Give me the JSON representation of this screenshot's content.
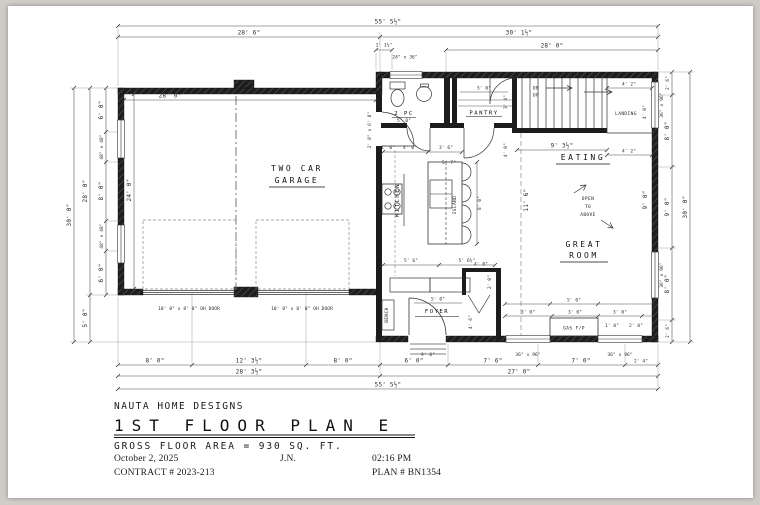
{
  "title_block": {
    "company": "NAUTA HOME DESIGNS",
    "title": "1ST FLOOR PLAN E",
    "area": "GROSS FLOOR AREA = 930 SQ. FT.",
    "date": "October 2, 2025",
    "initials": "J.N.",
    "time": "02:16 PM",
    "contract": "CONTRACT # 2023-213",
    "plan_no": "PLAN # BN1354"
  },
  "rooms": {
    "garage_line1": "TWO CAR",
    "garage_line2": "GARAGE",
    "kitchen": "KITCHEN",
    "island": "ISLAND",
    "pantry": "PANTRY",
    "powder": "2 PC",
    "eating": "EATING",
    "great_line1": "GREAT",
    "great_line2": "ROOM",
    "foyer": "FOYER",
    "landing": "LANDING",
    "bench": "BENCH",
    "gas_fp": "GAS F/P",
    "open1": "OPEN",
    "open2": "TO",
    "open3": "ABOVE",
    "dn": "DN",
    "up": "UP"
  },
  "dims": {
    "top_total": "55' 5½\"",
    "top_left": "28' 6\"",
    "top_right": "30' 1½\"",
    "top_jog": "1' 1½\"",
    "top_right2": "28' 0\"",
    "win_24x36": "24\" x 36\"",
    "left_outer": "30' 0\"",
    "left_upper": "28' 0\"",
    "left_lower": "5' 0\"",
    "left_seg_a": "6' 0\"",
    "left_win_a": "48\" x 48\"",
    "left_seg_b": "8' 0\"",
    "left_win_b": "48\" x 48\"",
    "left_seg_c": "6' 0\"",
    "right_outer": "30' 0\"",
    "right_seg_a": "2' 6\"",
    "right_seg_b": "8' 0\"",
    "right_seg_c": "9' 0\"",
    "right_seg_d": "8' 0\"",
    "right_seg_e": "2' 6\"",
    "win_36x96": "36\" x 96\"",
    "garage_w": "28' 0\"",
    "garage_h": "24' 0\"",
    "oh_door": "10' 0\" x 8' 0\" OH DOOR",
    "man_door": "2' 8\" x 6' 8\"",
    "bot_a": "8' 0\"",
    "bot_b": "12' 3½\"",
    "bot_c": "8' 0\"",
    "bot_d": "6' 0\"",
    "bot_e": "7' 6\"",
    "bot_f": "7' 0\"",
    "bot_g": "2' 4\"",
    "bot_left": "28' 3½\"",
    "bot_right": "27' 0\"",
    "bot_total": "55' 5½\"",
    "porch": "9' 0\"",
    "pow_w": "5' 0\"",
    "pan_w": "5' 0\"",
    "pan_d": "3' 4\"",
    "hall_w": "5' 7\"",
    "hall_d": "4' 0\"",
    "stair_run": "9' 3½\"",
    "land_a": "4' 2\"",
    "land_b": "4' 2\"",
    "land_w": "4' 0\"",
    "kit_a": "1' 0\"",
    "kit_b": "4' 0\"",
    "kit_c": "3' 6\"",
    "kit_d": "8' 0\"",
    "kit_e": "5' 6\"",
    "kit_f": "5' 6½\"",
    "foy_w": "5' 0\"",
    "foy_d": "4' 6\"",
    "clo_w": "4' 0\"",
    "clo_d": "2' 0\"",
    "gr_w": "5' 0\"",
    "gr_a": "3' 0\"",
    "gr_b": "3' 0\"",
    "gr_c": "3' 0\"",
    "gr_d": "1' 0\"",
    "gr_e": "2' 0\"",
    "gr_depth": "11' 6\"",
    "gr_right": "9' 0\""
  }
}
